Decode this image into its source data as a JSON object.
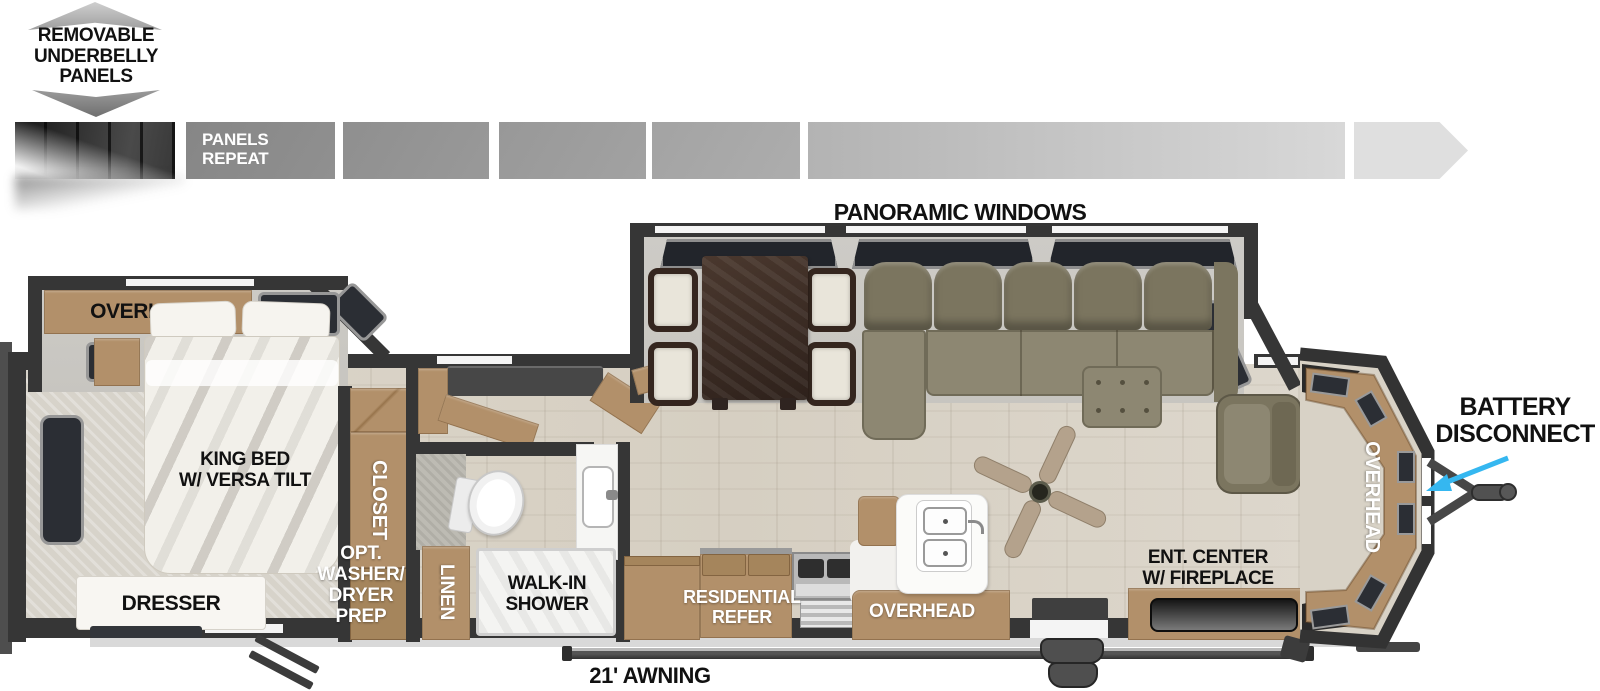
{
  "underbelly": {
    "lines": [
      "REMOVABLE",
      "UNDERBELLY",
      "PANELS"
    ]
  },
  "strip": {
    "label_lines": [
      "PANELS",
      "REPEAT"
    ]
  },
  "living": {
    "panoramic_label": "PANORAMIC WINDOWS",
    "ent_lines": [
      "ENT. CENTER",
      "W/ FIREPLACE"
    ],
    "front_overhead_label": "OVERHEAD"
  },
  "bedroom": {
    "overhead_label": "OVERHEAD",
    "king_bed_lines": [
      "KING BED",
      "W/ VERSA TILT"
    ],
    "dresser_label": "DRESSER",
    "closet_label": "CLOSET",
    "washer_lines": [
      "OPT.",
      "WASHER/",
      "DRYER",
      "PREP"
    ]
  },
  "bathroom": {
    "linen_label": "LINEN",
    "shower_lines": [
      "WALK-IN",
      "SHOWER"
    ]
  },
  "kitchen": {
    "refer_lines": [
      "RESIDENTIAL",
      "REFER"
    ],
    "overhead_label": "OVERHEAD"
  },
  "exterior": {
    "battery_lines": [
      "BATTERY",
      "DISCONNECT"
    ],
    "awning_label": "21' AWNING"
  },
  "colors": {
    "wall": "#363636",
    "floor": "#d8d2c6",
    "slide_floor": "#cbc9c4",
    "cabinet": "#b2906a",
    "cabinet_dark": "#a5855c",
    "sofa": "#8d8772",
    "sofa_dark": "#7b755f",
    "table_wood": "#3e2e26",
    "window_dark": "#2b2e34",
    "window_frame": "#979797",
    "label_black": "#111111",
    "label_white": "#ffffff",
    "arrow_cyan": "#35b7f0",
    "trim_gray": "#d9d9d9",
    "panel_dark": "#1c1c1c",
    "strip_grays": [
      "#8c8c8c",
      "#949494",
      "#9d9d9d",
      "#a7a7a7",
      "#c6c6c6",
      "#dfdfdf"
    ]
  }
}
